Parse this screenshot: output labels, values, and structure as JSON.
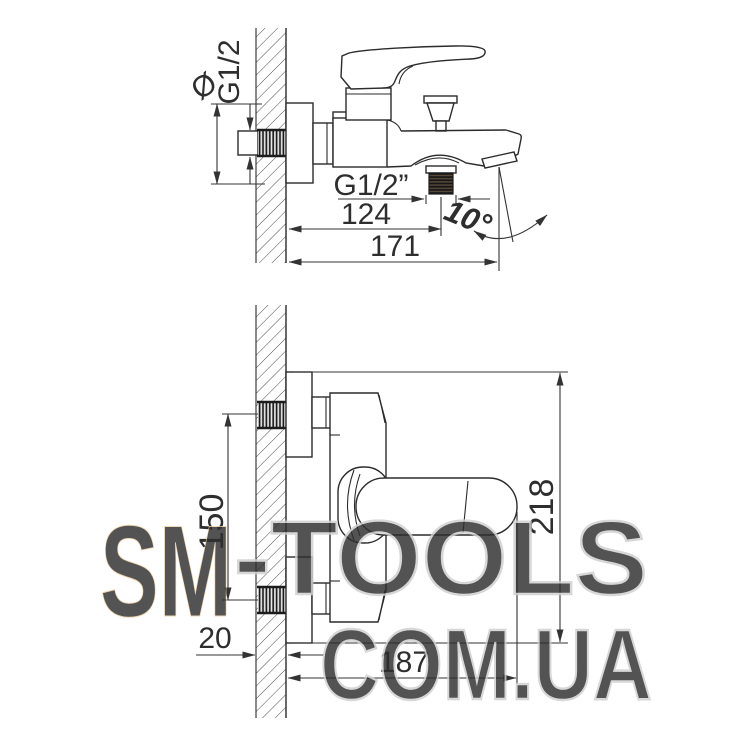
{
  "drawing_title": "wall-mounted bath mixer installation dimensions",
  "top_view": {
    "labels": {
      "diameter_symbol": "Ø",
      "wall_thread_size": "G1/2",
      "outlet_thread_size": "G1/2”",
      "wall_to_outlet_mm": "124",
      "total_depth_mm": "171",
      "spout_angle_deg": "10°"
    }
  },
  "bottom_view": {
    "labels": {
      "inlet_spacing_mm": "150",
      "total_height_mm": "218",
      "wall_thickness_mm": "20",
      "total_depth_mm": "187"
    }
  },
  "watermark": {
    "brand_primary": "SM",
    "brand_secondary": "-TOOLS",
    "domain": "COM.UA"
  },
  "colors": {
    "line": "#2b2b2b",
    "dimension_line": "#333333",
    "watermark_orange": "#f7ddba",
    "watermark_gray": "#cfcfcf",
    "background": "#ffffff"
  }
}
